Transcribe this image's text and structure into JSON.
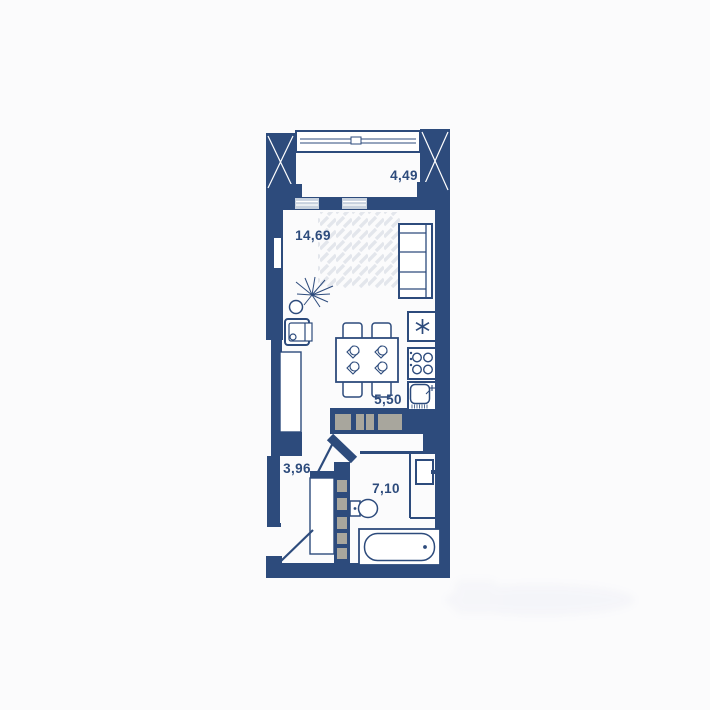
{
  "rooms": {
    "balcony": {
      "area_label": "4,49"
    },
    "living_room": {
      "area_label": "14,69"
    },
    "kitchen": {
      "area_label": "5,50"
    },
    "hallway": {
      "area_label": "3,96"
    },
    "bathroom": {
      "area_label": "7,10"
    }
  },
  "colors": {
    "wall": "#2d4b7c",
    "cabinet_gray": "#a8a69d",
    "glass": "#c7d1de",
    "rug_hatch": "#e3e6ec",
    "background": "#fbfbfc"
  },
  "icons": {
    "furniture": [
      "window-icon",
      "door-swing-icon",
      "sofa-icon",
      "armchair-icon",
      "potted-plant-icon",
      "rug-icon",
      "dining-table-icon",
      "chair-icon",
      "place-setting-icon",
      "fridge-icon",
      "stove-icon",
      "kitchen-sink-icon",
      "kitchen-cabinets-icon",
      "wardrobe-hangers-icon",
      "toilet-icon",
      "bathtub-icon",
      "water-heater-icon"
    ]
  }
}
